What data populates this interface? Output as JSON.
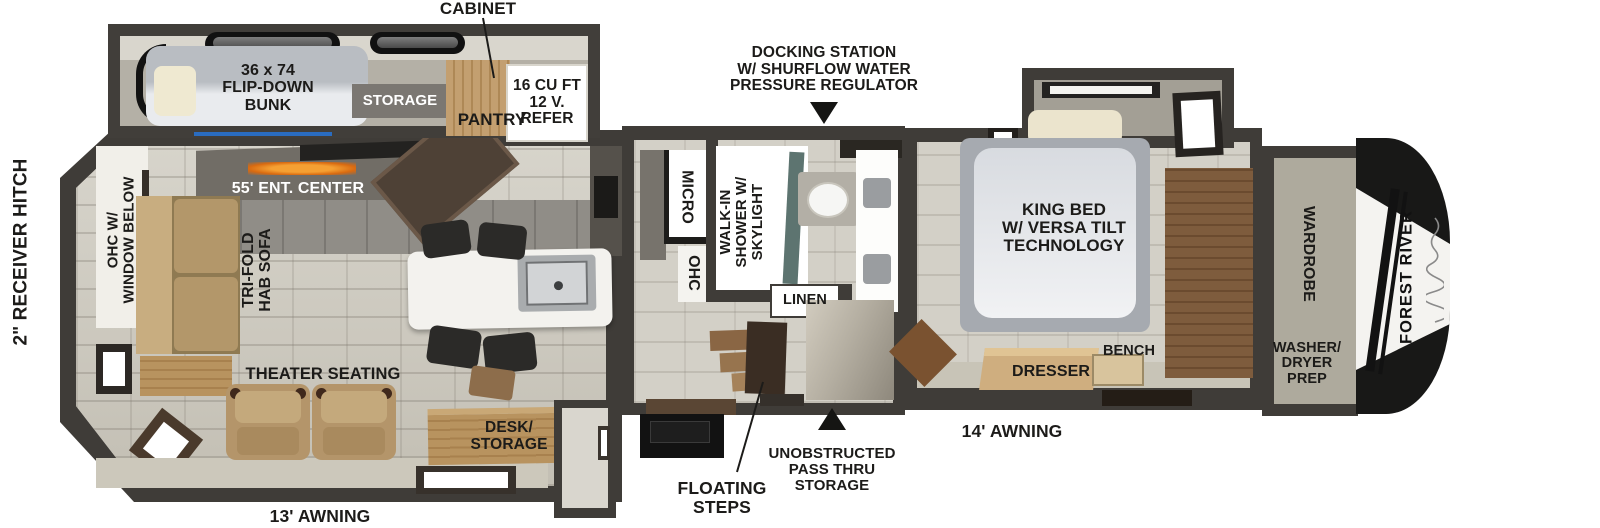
{
  "fp": {
    "hitch": "2\" RECEIVER HITCH",
    "cabinet": "CABINET",
    "bunk": "36 x 74\nFLIP-DOWN\nBUNK",
    "storage": "STORAGE",
    "pantry": "PANTRY",
    "refer": "16 CU FT\n12 V.\nREFER",
    "docking": "DOCKING STATION\nW/ SHURFLOW WATER\nPRESSURE REGULATOR",
    "ohc_window": "OHC W/\nWINDOW BELOW",
    "ent_center": "55' ENT. CENTER",
    "sofa": "TRI-FOLD\nHAB SOFA",
    "micro": "MICRO",
    "ohc": "OHC",
    "shower": "WALK-IN\nSHOWER W/\nSKYLIGHT",
    "linen": "LINEN",
    "king_bed": "KING BED\nW/ VERSA TILT\nTECHNOLOGY",
    "wardrobe": "WARDROBE",
    "brand": "FOREST RIVER",
    "washer_dryer": "WASHER/\nDRYER\nPREP",
    "bench": "BENCH",
    "dresser": "DRESSER",
    "theater": "THEATER SEATING",
    "desk": "DESK/\nSTORAGE",
    "pass_thru": "UNOBSTRUCTED\nPASS THRU\nSTORAGE",
    "floating_steps": "FLOATING\nSTEPS",
    "awning_front": "14' AWNING",
    "awning_rear": "13' AWNING"
  },
  "colors": {
    "wall": "#3f3c38",
    "accent_blue": "#2a6cc0",
    "fireplace_glow": "#e8831e",
    "wood": "#b08c5e"
  }
}
